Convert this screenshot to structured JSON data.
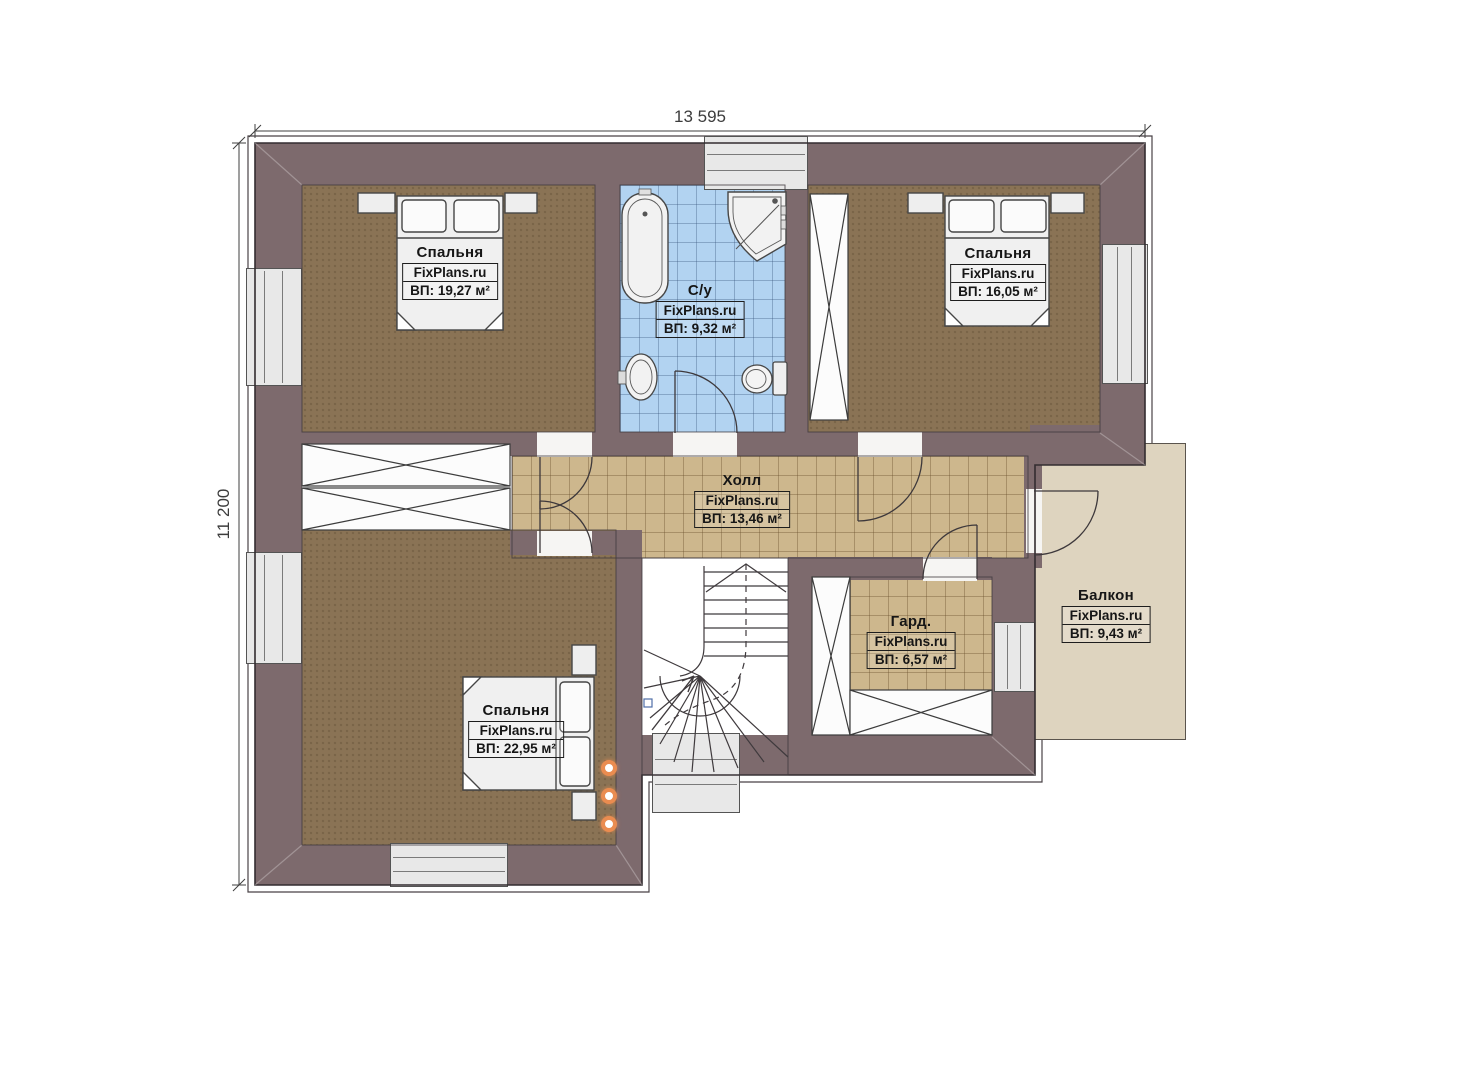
{
  "plan": {
    "dimensions": {
      "width_label": "13 595",
      "height_label": "11 200"
    },
    "rooms": [
      {
        "key": "bedroom-top-left",
        "name": "Спальня",
        "brand": "FixPlans.ru",
        "area": "ВП: 19,27 м²"
      },
      {
        "key": "bathroom",
        "name": "С/у",
        "brand": "FixPlans.ru",
        "area": "ВП: 9,32 м²"
      },
      {
        "key": "bedroom-top-right",
        "name": "Спальня",
        "brand": "FixPlans.ru",
        "area": "ВП: 16,05 м²"
      },
      {
        "key": "hall",
        "name": "Холл",
        "brand": "FixPlans.ru",
        "area": "ВП: 13,46 м²"
      },
      {
        "key": "bedroom-bottom",
        "name": "Спальня",
        "brand": "FixPlans.ru",
        "area": "ВП: 22,95 м²"
      },
      {
        "key": "wardrobe",
        "name": "Гард.",
        "brand": "FixPlans.ru",
        "area": "ВП: 6,57 м²"
      },
      {
        "key": "balcony",
        "name": "Балкон",
        "brand": "FixPlans.ru",
        "area": "ВП: 9,43 м²"
      }
    ],
    "colors": {
      "wall": "#7d6a6d",
      "bedroom_floor": "#8a7355",
      "hall_tile": "#cdb78d",
      "bath_tile": "#b2d3f1",
      "balcony_floor": "#ded4bf",
      "spotlight_accent": "#ea8c50"
    }
  }
}
